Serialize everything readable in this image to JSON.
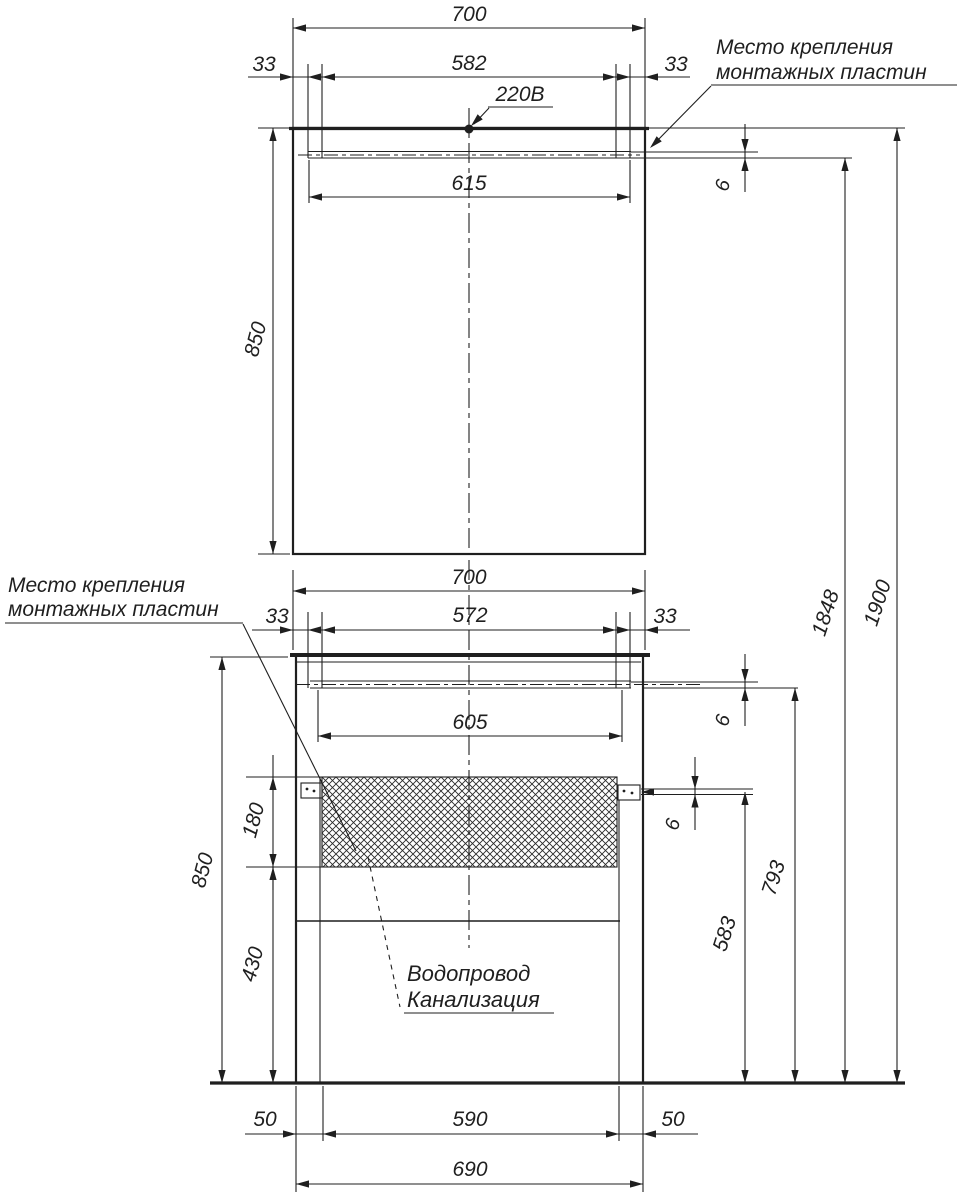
{
  "drawing_type": "installation-dimension-drawing",
  "colors": {
    "line": "#1f1f1f",
    "background": "#ffffff"
  },
  "notes": {
    "power": "220В",
    "mount_top_1": "Место крепления",
    "mount_top_2": "монтажных пластин",
    "mount_left_1": "Место крепления",
    "mount_left_2": "монтажных пластин",
    "plumbing_1": "Водопровод",
    "plumbing_2": "Канализация"
  },
  "dims": {
    "mirror_width": "700",
    "mirror_offset_left": "33",
    "mirror_plate_span": "582",
    "mirror_offset_right": "33",
    "mirror_plate_width": "615",
    "mirror_height": "850",
    "mirror_plate_gap": "6",
    "cabinet_width": "700",
    "cabinet_offset_left": "33",
    "cabinet_plate_span": "572",
    "cabinet_offset_right": "33",
    "cabinet_plate_width": "605",
    "countertop_gap": "6",
    "plate_thickness": "6",
    "cabinet_height": "850",
    "hatch_height": "180",
    "bottom_height": "430",
    "drain_line_height": "583",
    "cabinet_plate_height": "793",
    "mirror_plate_height": "1848",
    "total_height": "1900",
    "base_offset_left": "50",
    "base_inner_width": "590",
    "base_offset_right": "50",
    "base_width": "690"
  }
}
